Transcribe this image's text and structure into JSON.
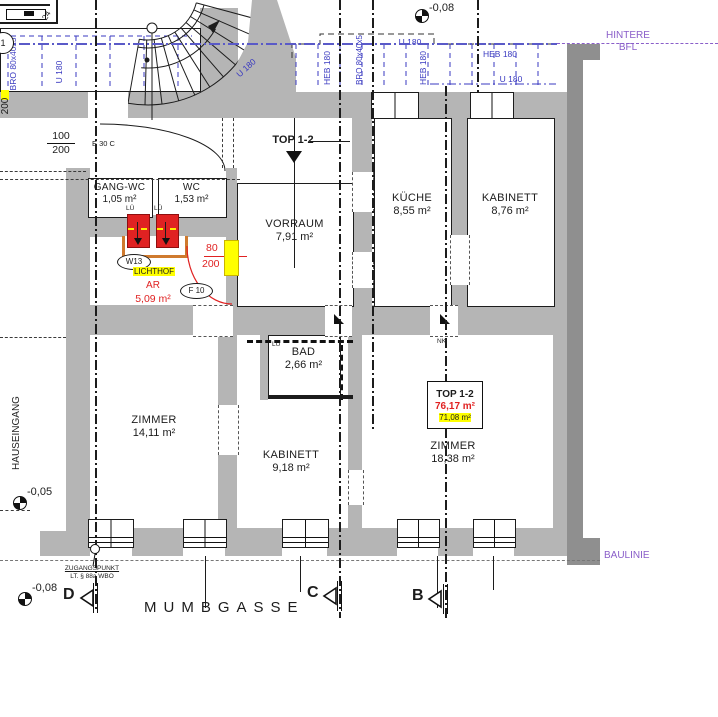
{
  "colors": {
    "wall_gray": "#b5b5b5",
    "wall_dark": "#8f8f8f",
    "annotation_blue": "#3a3ac0",
    "boundary_purple": "#8a5ec9",
    "new_construction_red": "#e02222",
    "highlight_yellow": "#ffff00"
  },
  "title": {
    "top_unit": "TOP 1-2"
  },
  "rooms": [
    {
      "name": "GANG-WC",
      "area": "1,05 m²"
    },
    {
      "name": "WC",
      "area": "1,53 m²"
    },
    {
      "name": "VORRAUM",
      "area": "7,91 m²"
    },
    {
      "name": "KÜCHE",
      "area": "8,55 m²"
    },
    {
      "name": "KABINETT",
      "area": "8,76 m²"
    },
    {
      "name": "BAD",
      "area": "2,66 m²"
    },
    {
      "name": "ZIMMER",
      "area": "14,11 m²"
    },
    {
      "name": "KABINETT",
      "area": "9,18 m²"
    },
    {
      "name": "ZIMMER",
      "area": "18,38 m²"
    }
  ],
  "unit_box": {
    "title": "TOP 1-2",
    "area_new": "76,17 m²",
    "area_old": "71,08 m²"
  },
  "lichthof": {
    "window_tag": "W13",
    "label": "LICHTHOF",
    "code": "AR",
    "area": "5,09 m²",
    "door_tag": "F 10",
    "door_width": "80",
    "door_height": "200"
  },
  "entry_door": {
    "width": "100",
    "height": "200",
    "fire_rating": "E 30 C"
  },
  "beams": {
    "u180": "U 180",
    "heb180": "HEB 180",
    "bro": "BRO 80x40x5"
  },
  "site": {
    "hintere_line1": "HINTERE",
    "hintere_line2": "BFL",
    "baulinie": "BAULINIE",
    "street": "MUMBGASSE",
    "hauseingang": "HAUSEINGANG",
    "zugang_line1": "ZUGANGSPUNKT",
    "zugang_line2": "LT. § 88a WBO"
  },
  "levels": {
    "top": "-0,08",
    "entry": "-0,05",
    "street": "-0,08"
  },
  "sections": {
    "d": "D",
    "c": "C",
    "b": "B"
  },
  "small": {
    "lu": "LÜ",
    "nk": "NK",
    "wall_height": "200",
    "corner": "24",
    "pos": "1"
  }
}
